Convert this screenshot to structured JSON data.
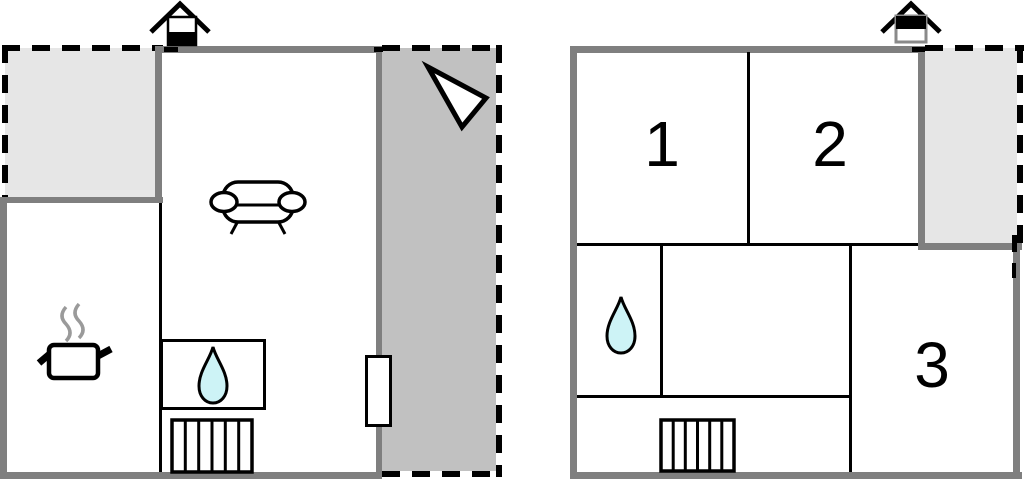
{
  "palette": {
    "wall_gray": "#7f7f7f",
    "terrace_light": "#e6e6e6",
    "terrace_dark": "#c1c1c1",
    "drop_fill": "#cdf3f6",
    "steam_gray": "#9a9a9a",
    "line_black": "#000000",
    "paper_white": "#ffffff"
  },
  "left_plan": {
    "icons": [
      "chimney-icon",
      "north-arrow-icon",
      "sofa-icon",
      "cooking-pot-icon",
      "water-drop-icon",
      "stairs-icon",
      "door-icon"
    ]
  },
  "right_plan": {
    "rooms": [
      {
        "label": "1"
      },
      {
        "label": "2"
      },
      {
        "label": "3"
      }
    ],
    "icons": [
      "chimney-icon",
      "water-drop-icon",
      "stairs-icon"
    ]
  }
}
